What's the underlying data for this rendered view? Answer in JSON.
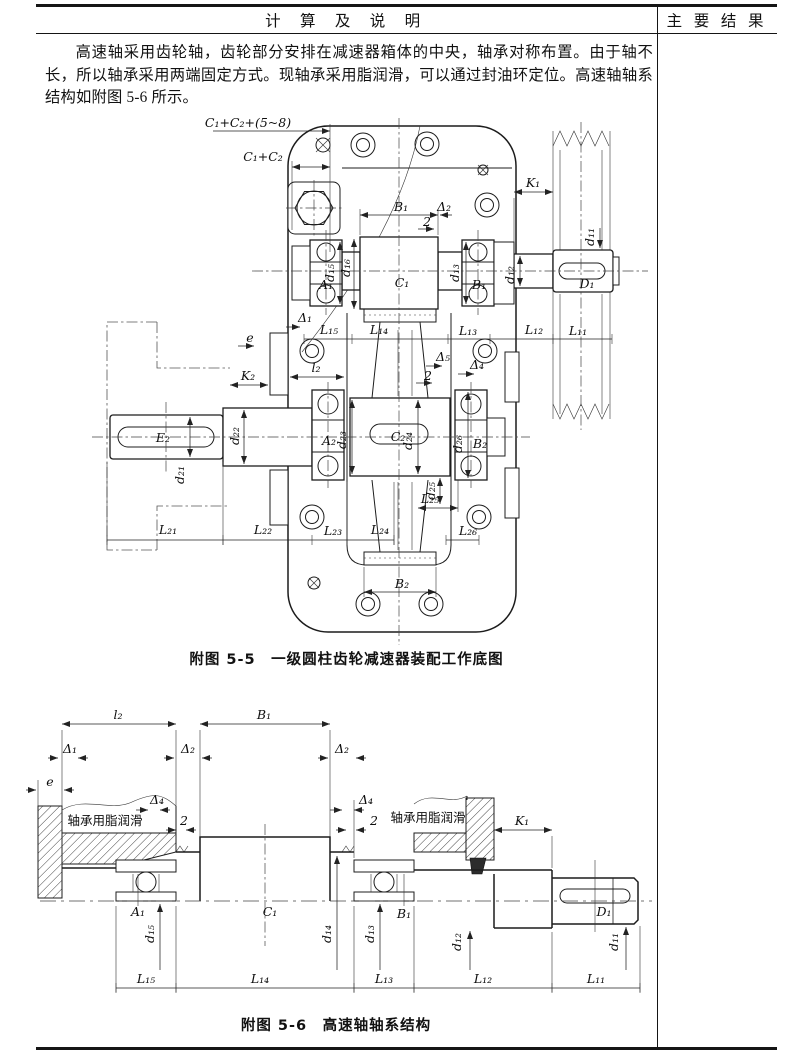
{
  "header": {
    "left_title": "计 算 及 说 明",
    "right_title": "主 要 结 果"
  },
  "body": {
    "paragraph": "高速轴采用齿轮轴，齿轮部分安排在减速器箱体的中央，轴承对称布置。由于轴不长，所以轴承采用两端固定方式。现轴承采用脂润滑，可以通过封油环定位。高速轴轴系结构如附图 5-6 所示。"
  },
  "fig55": {
    "caption": "附图 5-5　一级圆柱齿轮减速器装配工作底图",
    "labels": {
      "c1c2_58": "C₁+C₂+(5~8)",
      "c1c2": "C₁+C₂",
      "k1": "K₁",
      "b1_top": "B₁",
      "delta2": "Δ₂",
      "two_top": "2",
      "a1": "A₁",
      "d15": "d₁₅",
      "d16": "d₁₆",
      "c1": "C₁",
      "d13": "d₁₃",
      "b1": "B₁",
      "d12": "d₁₂",
      "d11": "d₁₁",
      "dd1": "D₁",
      "delta1": "Δ₁",
      "e": "e",
      "l15": "L₁₅",
      "l14": "L₁₄",
      "l13": "L₁₃",
      "l12": "L₁₂",
      "l11": "L₁₁",
      "l2": "l₂",
      "k2": "K₂",
      "delta5": "Δ₅",
      "delta4": "Δ₄",
      "two_mid": "2",
      "e2": "E₂",
      "d22": "d₂₂",
      "a2": "A₂",
      "d23": "d₂₃",
      "c2": "C₂",
      "d24": "d₂₄",
      "d26": "d₂₆",
      "b2": "B₂",
      "d21": "d₂₁",
      "d25": "d₂₅",
      "l25": "L₂₅",
      "l21": "L₂₁",
      "l22": "L₂₂",
      "l23": "L₂₃",
      "l24": "L₂₄",
      "l26": "L₂₆",
      "b2_bottom": "B₂"
    }
  },
  "fig56": {
    "caption": "附图 5-6　高速轴轴系结构",
    "labels": {
      "l2": "l₂",
      "b1": "B₁",
      "delta1": "Δ₁",
      "delta2_left": "Δ₂",
      "delta2_right": "Δ₂",
      "e": "e",
      "delta4_left": "Δ₄",
      "two_left": "2",
      "grease_left": "轴承用脂润滑",
      "delta4_right": "Δ₄",
      "two_right": "2",
      "grease_right": "轴承用脂润滑",
      "k1": "K₁",
      "a1": "A₁",
      "c1": "C₁",
      "b1_hub": "B₁",
      "dd1": "D₁",
      "d15": "d₁₅",
      "d14": "d₁₄",
      "d13": "d₁₃",
      "d12": "d₁₂",
      "d11": "d₁₁",
      "l15": "L₁₅",
      "l14": "L₁₄",
      "l13": "L₁₃",
      "l12": "L₁₂",
      "l11": "L₁₁"
    }
  }
}
